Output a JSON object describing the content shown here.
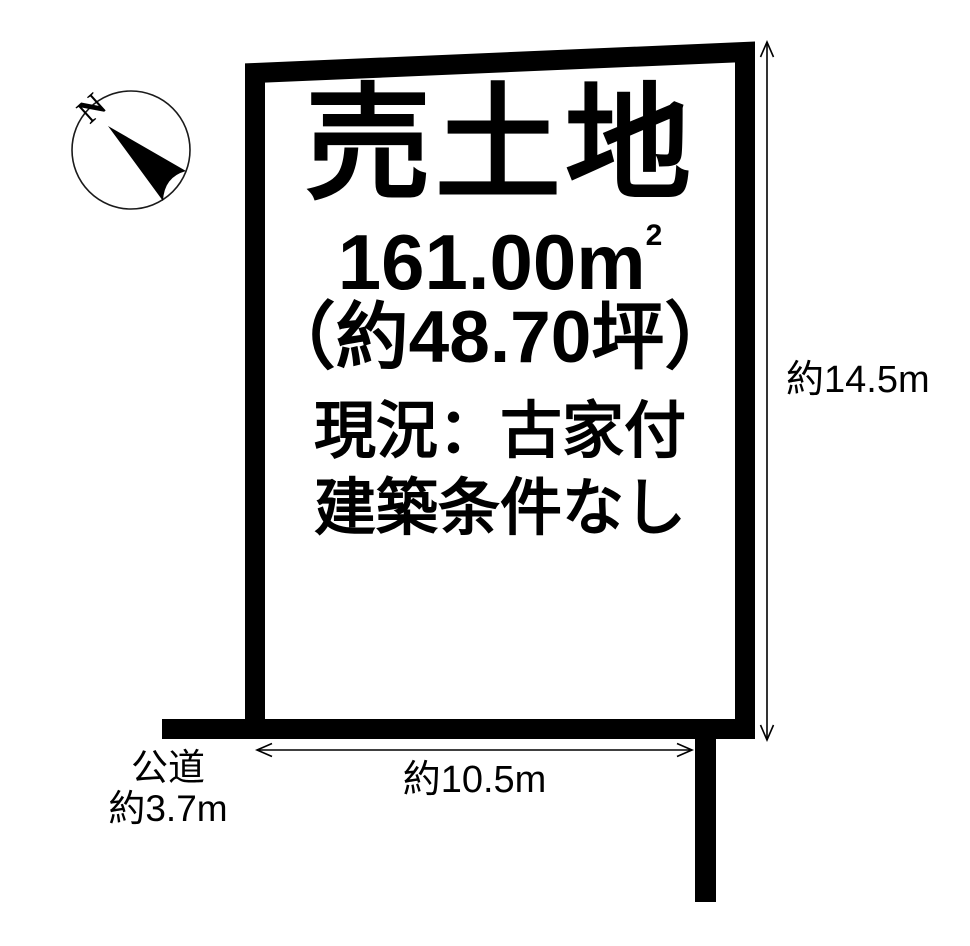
{
  "page": {
    "background_color": "#ffffff",
    "line_color": "#000000"
  },
  "compass": {
    "north_label": "N"
  },
  "plot": {
    "title": "売土地",
    "area_main": "161.00m",
    "area_sup": "2",
    "area_tsubo": "（約48.70坪）",
    "status": "現況：古家付",
    "condition": "建築条件なし"
  },
  "dimensions": {
    "height": "約14.5m",
    "width": "約10.5m",
    "road": {
      "line1": "公道",
      "line2": "約3.7m"
    }
  }
}
